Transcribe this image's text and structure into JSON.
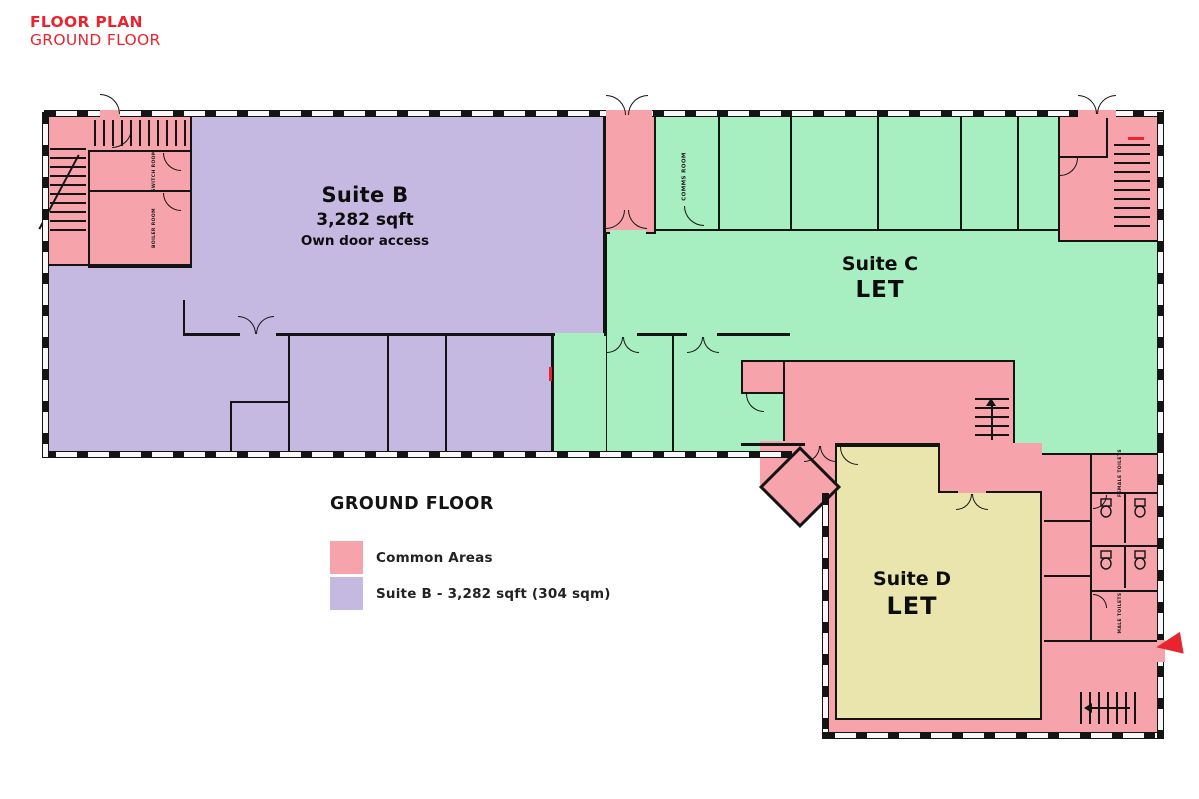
{
  "header": {
    "line1": "FLOOR PLAN",
    "line2": "GROUND FLOOR"
  },
  "plan": {
    "suite_b": {
      "name": "Suite B",
      "area": "3,282 sqft",
      "note": "Own door access"
    },
    "suite_c": {
      "name": "Suite C",
      "status": "LET"
    },
    "suite_d": {
      "name": "Suite D",
      "status": "LET"
    },
    "rooms": {
      "switch_room": "SWITCH ROOM",
      "boiler_room": "BOILER ROOM",
      "comms_room": "COMMS ROOM",
      "female_toilets": "FEMALE TOILETS",
      "male_toilets": "MALE TOILETS"
    }
  },
  "legend": {
    "title": "GROUND FLOOR",
    "items": [
      {
        "label": "Common Areas",
        "color": "#F7A3AC"
      },
      {
        "label": "Suite B - 3,282 sqft (304 sqm)",
        "color": "#C6B9E1"
      }
    ]
  },
  "colors": {
    "common_area": "#F7A3AC",
    "suite_b": "#C6B9E1",
    "suite_c": "#A7EEC1",
    "suite_d": "#EAE5AC",
    "accent_red": "#E8242F",
    "wall": "#141414"
  },
  "icons": [
    "stairs-icon",
    "door-arc-icon",
    "toilet-icon",
    "entrance-arrow-icon",
    "window-strip"
  ]
}
